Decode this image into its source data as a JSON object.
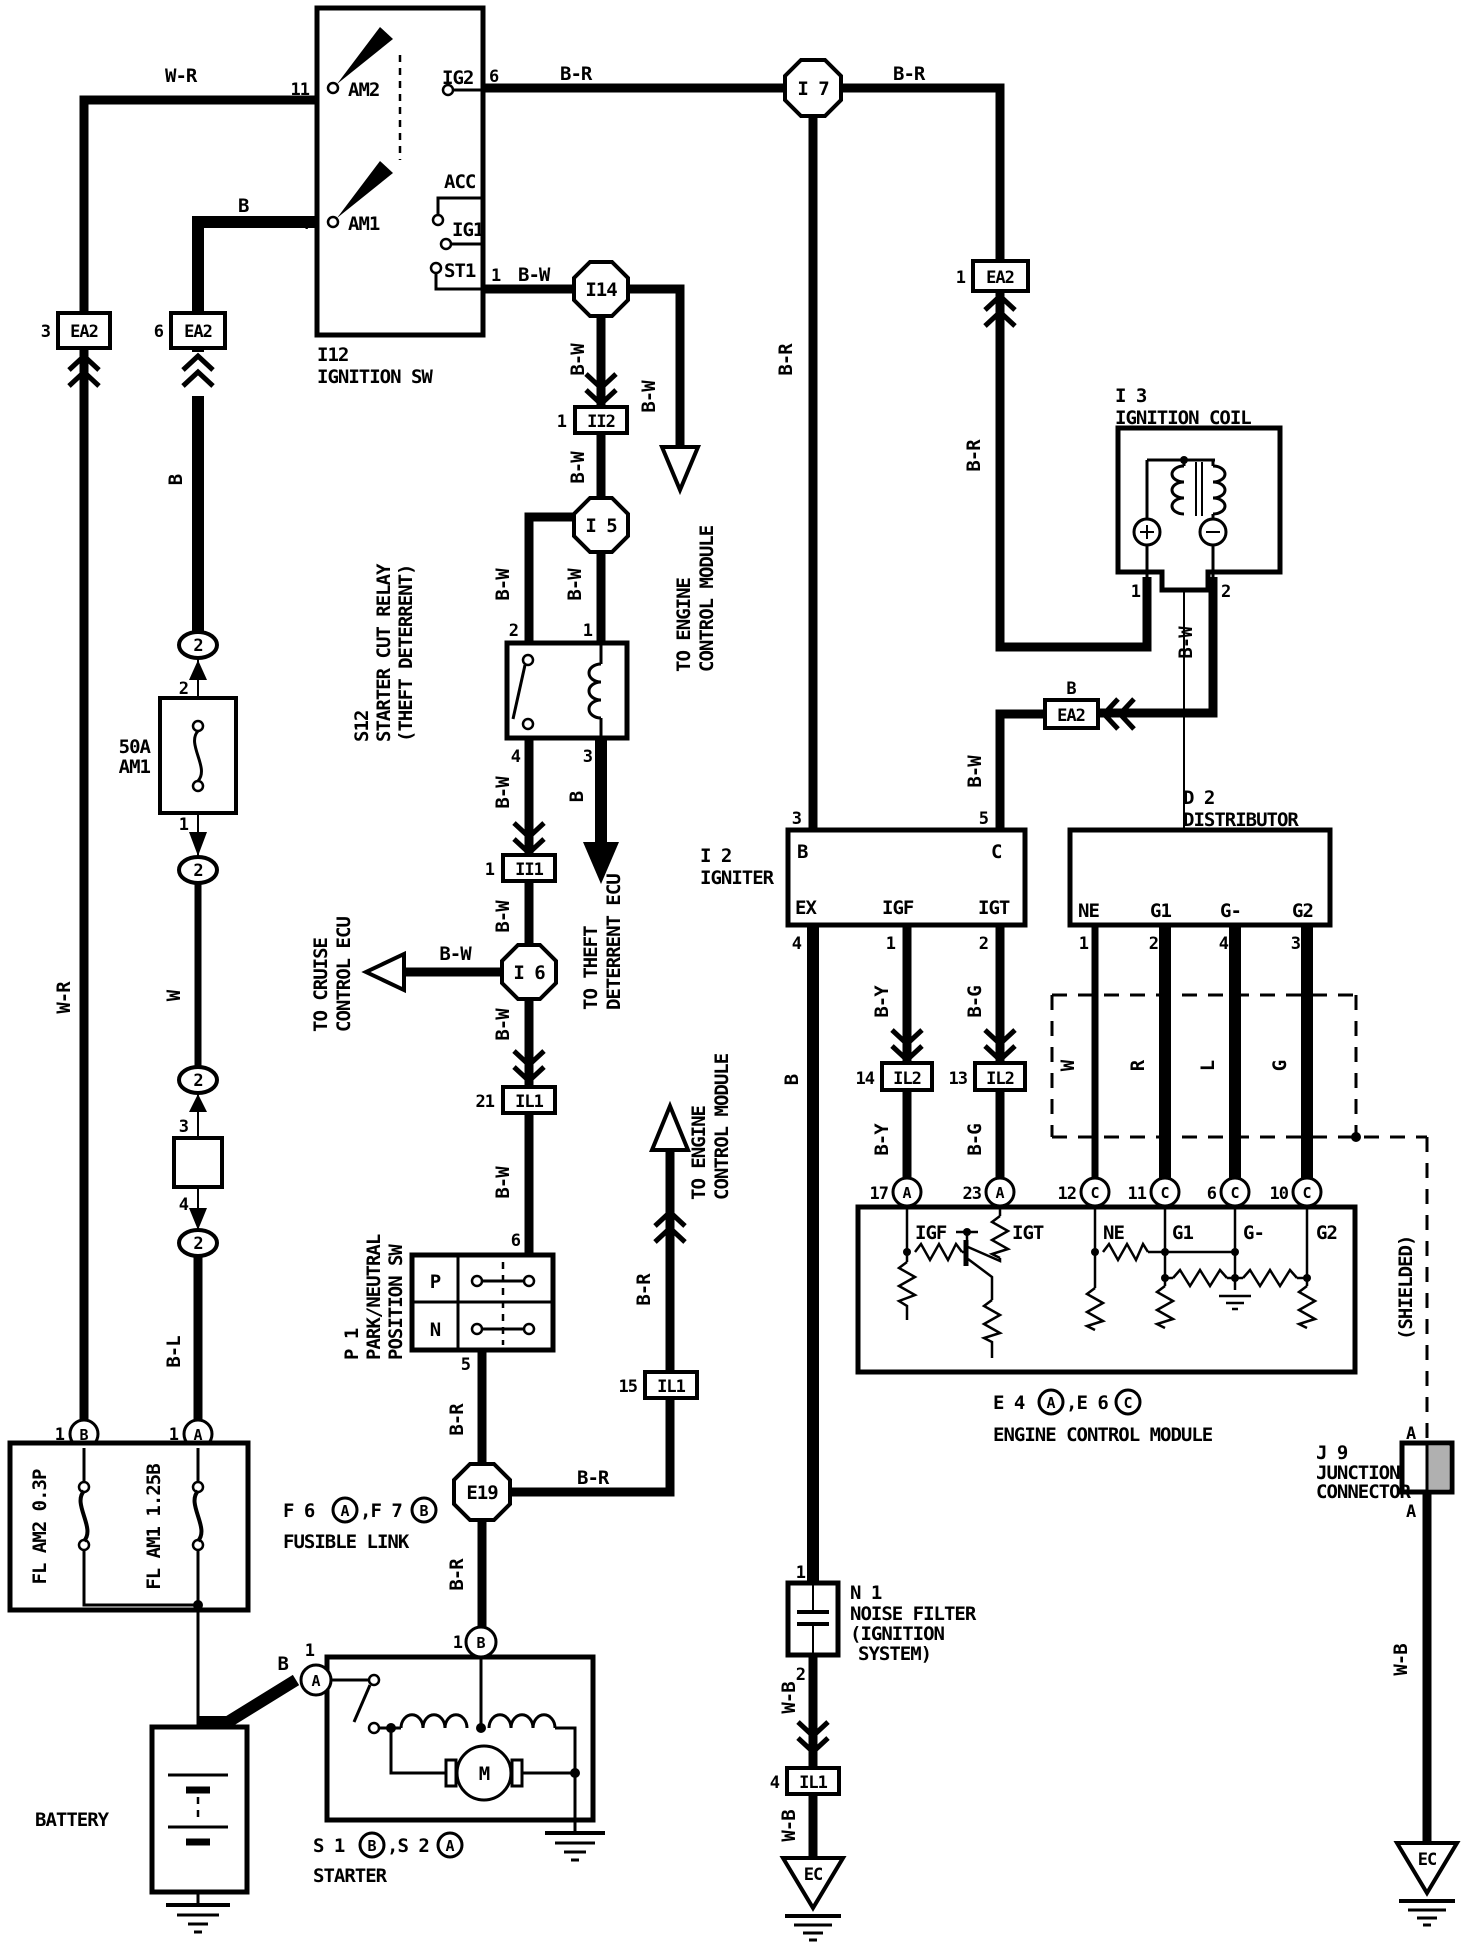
{
  "diagram": {
    "type": "automotive wiring diagram",
    "system": "ignition"
  },
  "wires": {
    "wr": "W-R",
    "b": "B",
    "br": "B-R",
    "bw": "B-W",
    "w": "W",
    "bl": "B-L",
    "by": "B-Y",
    "bg": "B-G",
    "wb": "W-B",
    "r": "R",
    "l": "L",
    "g": "G"
  },
  "junctions": {
    "i7": "I 7",
    "i14": "I14",
    "i5": "I 5",
    "i6": "I 6",
    "e19": "E19"
  },
  "connectors": {
    "ea2": "EA2",
    "ii2": "II2",
    "ii1": "II1",
    "il1": "IL1",
    "il2": "IL2",
    "oval2": "2",
    "ea2_3_pin": "3",
    "ea2_6_pin": "6",
    "ea2_1_pin": "1",
    "ea2_b_pin": "B",
    "ii2_pin": "1",
    "ii1_pin": "1",
    "il1_21_pin": "21",
    "il1_15_pin": "15",
    "il1_4_pin": "4",
    "il2_14_pin": "14",
    "il2_13_pin": "13"
  },
  "ignition_switch": {
    "id": "I12",
    "name": "IGNITION SW",
    "am2": "AM2",
    "am1": "AM1",
    "ig2": "IG2",
    "ig1": "IG1",
    "acc": "ACC",
    "st1": "ST1",
    "pin11": "11",
    "pin4": "4",
    "pin6": "6",
    "pin1": "1"
  },
  "starter_cut_relay": {
    "id": "S12",
    "line1": "STARTER CUT RELAY",
    "line2": "(THEFT DETERRENT)",
    "pin1": "1",
    "pin2": "2",
    "pin3": "3",
    "pin4": "4"
  },
  "park_neutral_sw": {
    "id": "P 1",
    "line1": "PARK/NEUTRAL",
    "line2": "POSITION SW",
    "p": "P",
    "n": "N",
    "pin6": "6",
    "pin5": "5"
  },
  "fuse_50a": {
    "rating": "50A",
    "name": "AM1",
    "pin2": "2",
    "pin1": "1"
  },
  "fuse_box2": {
    "pin3": "3",
    "pin4": "4"
  },
  "fusible_link": {
    "fl_am2": "FL AM2 0.3P",
    "fl_am1": "FL AM1 1.25B",
    "cap1": "F 6",
    "capA": "A",
    "cap2": ",F 7",
    "capB": "B",
    "cap3": "FUSIBLE LINK",
    "pin_b": "1",
    "pin_a": "1",
    "term_b": "B",
    "term_a": "A"
  },
  "battery": {
    "label": "BATTERY"
  },
  "starter": {
    "cap1": "S 1",
    "capB": "B",
    "cap2": ",S 2",
    "capA": "A",
    "cap3": "STARTER",
    "motor": "M",
    "pin_a": "1",
    "pin_b": "1",
    "term_a": "A",
    "term_b": "B"
  },
  "ignition_coil": {
    "id": "I 3",
    "name": "IGNITION COIL",
    "pin1": "1",
    "pin2": "2"
  },
  "igniter": {
    "id": "I 2",
    "name": "IGNITER",
    "b": "B",
    "c": "C",
    "ex": "EX",
    "igf": "IGF",
    "igt": "IGT",
    "pin3": "3",
    "pin5": "5",
    "pin4": "4",
    "pin1": "1",
    "pin2": "2"
  },
  "distributor": {
    "id": "D 2",
    "name": "DISTRIBUTOR",
    "ne": "NE",
    "g1": "G1",
    "gminus": "G-",
    "g2": "G2",
    "pin1": "1",
    "pin2": "2",
    "pin4": "4",
    "pin3": "3"
  },
  "ecm": {
    "cap1": "E 4",
    "capA": "A",
    "cap2": ",E 6",
    "capC": "C",
    "cap3": "ENGINE CONTROL MODULE",
    "igf": "IGF",
    "igt": "IGT",
    "ne": "NE",
    "g1": "G1",
    "gminus": "G-",
    "g2": "G2",
    "pin17": "17",
    "pin23": "23",
    "pin12": "12",
    "pin11": "11",
    "pin6": "6",
    "pin10": "10",
    "term_a": "A",
    "term_c": "C"
  },
  "noise_filter": {
    "id": "N 1",
    "line1": "NOISE FILTER",
    "line2": "(IGNITION",
    "line3": "SYSTEM)",
    "pin1": "1",
    "pin2": "2"
  },
  "junction_connector": {
    "id": "J 9",
    "line1": "JUNCTION",
    "line2": "CONNECTOR",
    "pin_a": "A"
  },
  "shield": {
    "label": "(SHIELDED)"
  },
  "ground": {
    "ec": "EC"
  },
  "destinations": {
    "engine1": "TO ENGINE",
    "engine2": "CONTROL MODULE",
    "cruise1": "TO CRUISE",
    "cruise2": "CONTROL ECU",
    "theft1": "TO THEFT",
    "theft2": "DETERRENT ECU"
  },
  "colors": {
    "ink": "#000000",
    "paper": "#ffffff"
  }
}
